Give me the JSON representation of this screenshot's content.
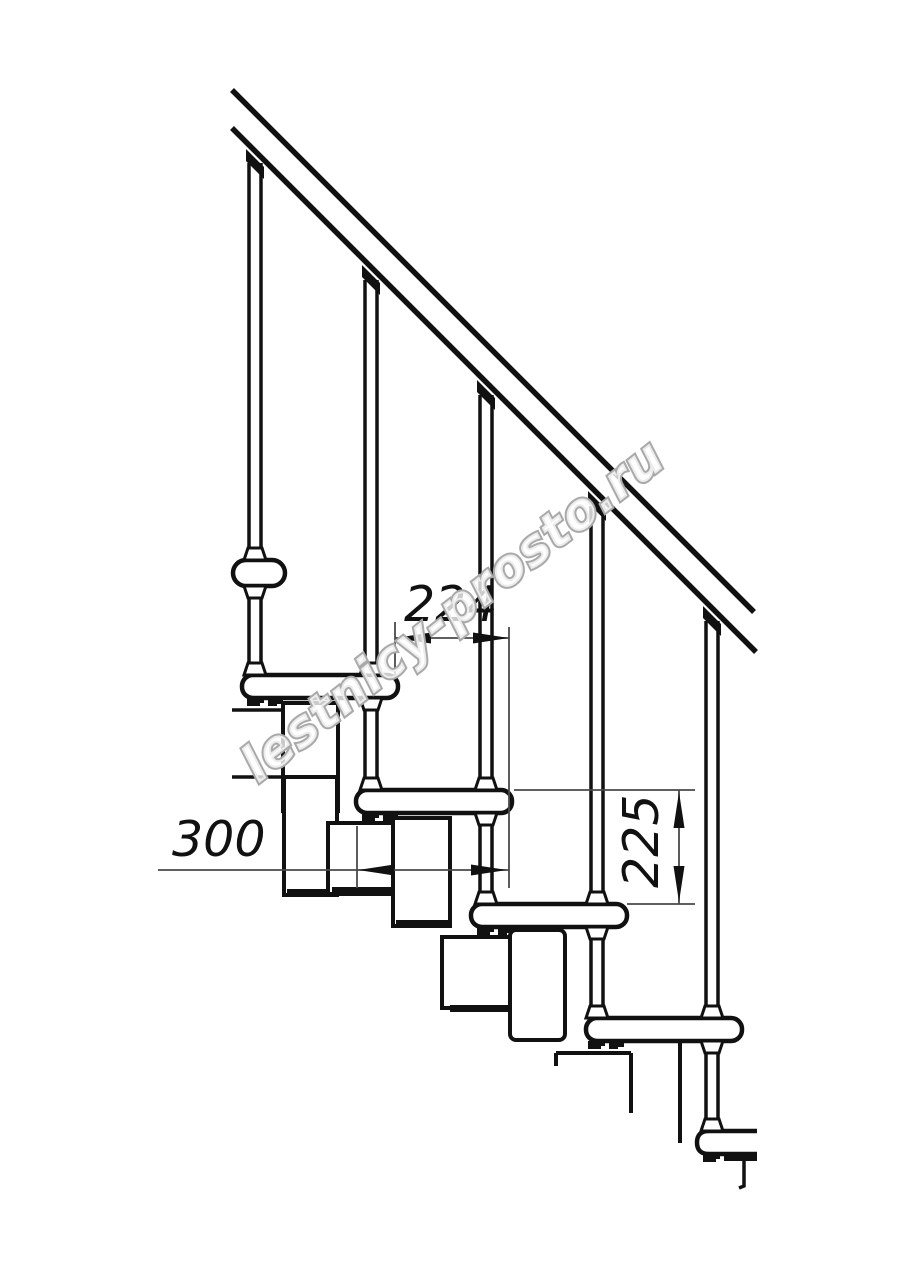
{
  "page": {
    "type": "technical-drawing",
    "background": "#ffffff"
  },
  "drawing": {
    "subject": "Modular staircase side elevation with railing",
    "watermark": "lestnicy-prosto.ru",
    "dimensions": {
      "step_offset_mm": "224",
      "tread_depth_mm": "300",
      "riser_height_mm": "225"
    },
    "colors": {
      "line": "#111111",
      "dimension_line": "#4a4a4a",
      "watermark_stroke": "#a9a9a9"
    }
  }
}
